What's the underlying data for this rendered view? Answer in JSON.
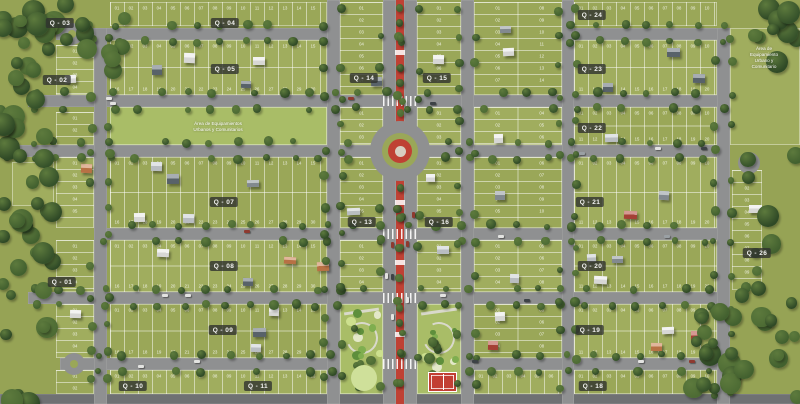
{
  "palette": {
    "grass": "#96a355",
    "block_a": "#9aa758",
    "block_b": "#a0ad5e",
    "park": "#a9bd67",
    "road": "#8f9091",
    "road_dark": "#6f7173",
    "median_red": "#bf4134",
    "court_red": "#c23f33",
    "lot_line": "rgba(255,255,255,0.5)",
    "chip_bg": "rgba(47,50,46,0.8)",
    "chip_text": "#f2f2f0",
    "label_text": "#ffffff",
    "tree_greens": [
      "#42602f",
      "#35512a",
      "#4d6b34",
      "#2f4926"
    ],
    "canopy_light": "#5d7a3d",
    "house_colors": [
      "#e9e9e7",
      "#c9cdd1",
      "#8d959b",
      "#5f6a72"
    ],
    "house_red": "#b2453a",
    "house_orange": "#c77b4a",
    "car_colors": [
      "#e3e3e1",
      "#3d4246",
      "#9aa0a4",
      "#8e3a30"
    ],
    "path": "#d9d9cb",
    "plaza": "#cfe09a",
    "round_core": "#d8cfc2"
  },
  "map": {
    "width": 800,
    "height": 404,
    "roads": [
      {
        "x": 56,
        "y": 28,
        "w": 284,
        "h": 12,
        "o": "h"
      },
      {
        "x": 562,
        "y": 28,
        "w": 168,
        "h": 12,
        "o": "h"
      },
      {
        "x": 28,
        "y": 95,
        "w": 702,
        "h": 12,
        "o": "h"
      },
      {
        "x": 0,
        "y": 145,
        "w": 730,
        "h": 12,
        "o": "h"
      },
      {
        "x": 94,
        "y": 228,
        "w": 636,
        "h": 12,
        "o": "h"
      },
      {
        "x": 28,
        "y": 292,
        "w": 702,
        "h": 12,
        "o": "h"
      },
      {
        "x": 60,
        "y": 358,
        "w": 280,
        "h": 12,
        "o": "h"
      },
      {
        "x": 461,
        "y": 358,
        "w": 269,
        "h": 12,
        "o": "h"
      },
      {
        "x": 0,
        "y": 394,
        "w": 800,
        "h": 10,
        "o": "h",
        "dark": true
      },
      {
        "x": 94,
        "y": 28,
        "w": 13,
        "h": 376,
        "o": "v"
      },
      {
        "x": 327,
        "y": 0,
        "w": 13,
        "h": 404,
        "o": "v"
      },
      {
        "x": 461,
        "y": 0,
        "w": 13,
        "h": 404,
        "o": "v"
      },
      {
        "x": 562,
        "y": 0,
        "w": 12,
        "h": 404,
        "o": "v"
      },
      {
        "x": 717,
        "y": 28,
        "w": 13,
        "h": 376,
        "o": "v"
      },
      {
        "x": 383,
        "y": 0,
        "w": 13,
        "h": 404,
        "o": "v",
        "blvd": true
      },
      {
        "x": 404,
        "y": 0,
        "w": 13,
        "h": 404,
        "o": "v",
        "blvd": true
      }
    ],
    "median": {
      "x": 396,
      "y": 0,
      "w": 8,
      "h": 404
    },
    "crosswalk_ys": [
      95,
      228,
      292,
      358
    ],
    "median_marks_ys": [
      50,
      200,
      260,
      332
    ],
    "roundabout": {
      "cx": 400,
      "cy": 151,
      "d_outer": 60,
      "d_grass": 36,
      "d_red": 24,
      "d_core": 11
    },
    "bulbs": [
      {
        "cx": 72,
        "cy": 34
      },
      {
        "cx": 74,
        "cy": 364
      },
      {
        "cx": 749,
        "cy": 163
      }
    ],
    "blocks": [
      {
        "x": 56,
        "y": 45,
        "w": 38,
        "h": 50,
        "s": "h"
      },
      {
        "x": 56,
        "y": 112,
        "w": 38,
        "h": 33,
        "s": "h"
      },
      {
        "x": 56,
        "y": 157,
        "w": 38,
        "h": 71,
        "s": "h"
      },
      {
        "x": 56,
        "y": 240,
        "w": 38,
        "h": 52,
        "s": "h"
      },
      {
        "x": 56,
        "y": 304,
        "w": 38,
        "h": 54,
        "s": "h"
      },
      {
        "x": 56,
        "y": 370,
        "w": 38,
        "h": 24,
        "s": "h"
      },
      {
        "x": 12,
        "y": 162,
        "w": 42,
        "h": 44,
        "s": "p"
      },
      {
        "x": 110,
        "y": 2,
        "w": 217,
        "h": 24,
        "s": "v"
      },
      {
        "x": 110,
        "y": 40,
        "w": 217,
        "h": 55,
        "s": "v"
      },
      {
        "x": 110,
        "y": 157,
        "w": 217,
        "h": 71,
        "s": "v"
      },
      {
        "x": 110,
        "y": 240,
        "w": 217,
        "h": 52,
        "s": "v"
      },
      {
        "x": 110,
        "y": 304,
        "w": 217,
        "h": 54,
        "s": "v"
      },
      {
        "x": 110,
        "y": 370,
        "w": 217,
        "h": 24,
        "s": "v"
      },
      {
        "x": 340,
        "y": 2,
        "w": 43,
        "h": 93,
        "s": "h"
      },
      {
        "x": 340,
        "y": 107,
        "w": 43,
        "h": 38,
        "s": "h"
      },
      {
        "x": 340,
        "y": 157,
        "w": 43,
        "h": 71,
        "s": "h"
      },
      {
        "x": 340,
        "y": 240,
        "w": 43,
        "h": 52,
        "s": "h"
      },
      {
        "x": 417,
        "y": 2,
        "w": 44,
        "h": 93,
        "s": "h"
      },
      {
        "x": 417,
        "y": 107,
        "w": 44,
        "h": 38,
        "s": "h"
      },
      {
        "x": 417,
        "y": 157,
        "w": 44,
        "h": 71,
        "s": "h"
      },
      {
        "x": 417,
        "y": 240,
        "w": 44,
        "h": 52,
        "s": "h"
      },
      {
        "x": 474,
        "y": 2,
        "w": 88,
        "h": 93,
        "s": "h2"
      },
      {
        "x": 474,
        "y": 107,
        "w": 88,
        "h": 38,
        "s": "h2"
      },
      {
        "x": 474,
        "y": 157,
        "w": 88,
        "h": 71,
        "s": "h2"
      },
      {
        "x": 474,
        "y": 240,
        "w": 88,
        "h": 52,
        "s": "h2"
      },
      {
        "x": 474,
        "y": 304,
        "w": 88,
        "h": 54,
        "s": "h2"
      },
      {
        "x": 474,
        "y": 370,
        "w": 88,
        "h": 24,
        "s": "v"
      },
      {
        "x": 574,
        "y": 2,
        "w": 143,
        "h": 24,
        "s": "v"
      },
      {
        "x": 574,
        "y": 40,
        "w": 143,
        "h": 55,
        "s": "v"
      },
      {
        "x": 574,
        "y": 107,
        "w": 143,
        "h": 38,
        "s": "v"
      },
      {
        "x": 574,
        "y": 157,
        "w": 143,
        "h": 71,
        "s": "v"
      },
      {
        "x": 574,
        "y": 240,
        "w": 143,
        "h": 52,
        "s": "v"
      },
      {
        "x": 574,
        "y": 304,
        "w": 143,
        "h": 54,
        "s": "v"
      },
      {
        "x": 574,
        "y": 370,
        "w": 143,
        "h": 24,
        "s": "v"
      },
      {
        "x": 730,
        "y": 28,
        "w": 70,
        "h": 117,
        "s": "p"
      },
      {
        "x": 732,
        "y": 170,
        "w": 30,
        "h": 120,
        "s": "h"
      }
    ],
    "parks": [
      {
        "x": 110,
        "y": 107,
        "w": 217,
        "h": 38,
        "kind": "flat"
      },
      {
        "x": 340,
        "y": 304,
        "w": 43,
        "h": 90,
        "kind": "play"
      },
      {
        "x": 417,
        "y": 304,
        "w": 44,
        "h": 90,
        "kind": "court"
      }
    ],
    "court": {
      "x": 428,
      "y": 372,
      "w": 29,
      "h": 20
    },
    "plaza": {
      "cx": 364,
      "cy": 378,
      "r": 13
    },
    "forests": [
      {
        "x": 0,
        "y": 0,
        "w": 54,
        "h": 404,
        "n": 46
      },
      {
        "x": 0,
        "y": 0,
        "w": 125,
        "h": 90,
        "n": 14
      },
      {
        "x": 752,
        "y": 0,
        "w": 48,
        "h": 64,
        "n": 10
      },
      {
        "x": 736,
        "y": 150,
        "w": 64,
        "h": 150,
        "n": 10
      },
      {
        "x": 688,
        "y": 298,
        "w": 112,
        "h": 106,
        "n": 26
      }
    ],
    "chips": [
      {
        "label": "Q - 03",
        "x": 60,
        "y": 23
      },
      {
        "label": "Q - 04",
        "x": 225,
        "y": 23
      },
      {
        "label": "Q - 02",
        "x": 57,
        "y": 80
      },
      {
        "label": "Q - 05",
        "x": 225,
        "y": 69
      },
      {
        "label": "Q - 14",
        "x": 364,
        "y": 78
      },
      {
        "label": "Q - 15",
        "x": 437,
        "y": 78
      },
      {
        "label": "Q - 24",
        "x": 592,
        "y": 15
      },
      {
        "label": "Q - 23",
        "x": 592,
        "y": 69
      },
      {
        "label": "Q - 22",
        "x": 592,
        "y": 128
      },
      {
        "label": "Q - 07",
        "x": 224,
        "y": 202
      },
      {
        "label": "Q - 21",
        "x": 590,
        "y": 202
      },
      {
        "label": "Q - 13",
        "x": 362,
        "y": 222
      },
      {
        "label": "Q - 16",
        "x": 439,
        "y": 222
      },
      {
        "label": "Q - 01",
        "x": 62,
        "y": 282
      },
      {
        "label": "Q - 08",
        "x": 224,
        "y": 266
      },
      {
        "label": "Q - 20",
        "x": 592,
        "y": 266
      },
      {
        "label": "Q - 26",
        "x": 757,
        "y": 253
      },
      {
        "label": "Q - 09",
        "x": 223,
        "y": 330
      },
      {
        "label": "Q - 19",
        "x": 590,
        "y": 330
      },
      {
        "label": "Q - 10",
        "x": 133,
        "y": 386
      },
      {
        "label": "Q - 11",
        "x": 258,
        "y": 386
      },
      {
        "label": "Q - 18",
        "x": 593,
        "y": 386
      }
    ],
    "area_labels": [
      {
        "text": "Área de Equipamientos\nUrbanos y Comunitarios",
        "x": 218,
        "y": 127
      },
      {
        "text": "Área de Equipamiento\nUrbano y Comunitario",
        "x": 764,
        "y": 58
      }
    ],
    "lot_numbers_visible": true
  }
}
